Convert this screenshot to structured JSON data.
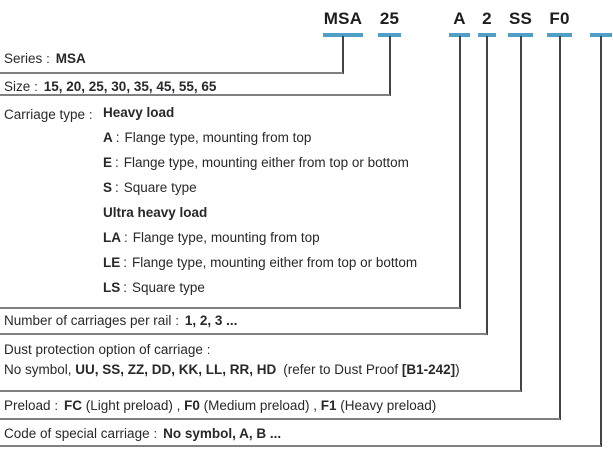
{
  "ui": {
    "colon": ":"
  },
  "colors": {
    "accent_blue": "#4f9fc6",
    "rule_gray": "#7e8083",
    "connector_gray": "#454347",
    "text": "#29272a"
  },
  "code": {
    "segments": [
      {
        "id": "series",
        "label": "MSA"
      },
      {
        "id": "size",
        "label": "25"
      },
      {
        "id": "carriage-type",
        "label": "A"
      },
      {
        "id": "carriages-per-rail",
        "label": "2"
      },
      {
        "id": "dust-protection",
        "label": "SS"
      },
      {
        "id": "preload",
        "label": "F0"
      },
      {
        "id": "special-carriage",
        "label": ""
      }
    ]
  },
  "rows": {
    "series": {
      "label": "Series",
      "value": "MSA"
    },
    "size": {
      "label": "Size",
      "value": "15, 20, 25, 30, 35, 45, 55, 65"
    },
    "carriage_type": {
      "label": "Carriage type",
      "groups": [
        {
          "heading": "Heavy load",
          "options": [
            {
              "code": "A",
              "desc": "Flange type, mounting from top"
            },
            {
              "code": "E",
              "desc": "Flange type, mounting either from top or bottom"
            },
            {
              "code": "S",
              "desc": "Square type"
            }
          ]
        },
        {
          "heading": "Ultra heavy load",
          "options": [
            {
              "code": "LA",
              "desc": "Flange type, mounting from top"
            },
            {
              "code": "LE",
              "desc": "Flange type, mounting either from top or bottom"
            },
            {
              "code": "LS",
              "desc": "Square type"
            }
          ]
        }
      ]
    },
    "carriages_per_rail": {
      "label": "Number of carriages per rail",
      "value": "1, 2, 3 ..."
    },
    "dust_protection": {
      "label": "Dust protection option of carriage",
      "prefix": "No symbol,",
      "codes": "UU, SS, ZZ, DD, KK, LL, RR, HD",
      "note_pre": "(refer to Dust Proof",
      "note_ref": "[B1-242]",
      "note_post": ")"
    },
    "preload": {
      "label": "Preload",
      "items": [
        {
          "code": "FC",
          "desc": "(Light preload) ,"
        },
        {
          "code": "F0",
          "desc": "(Medium preload) ,"
        },
        {
          "code": "F1",
          "desc": "(Heavy preload)"
        }
      ]
    },
    "special_carriage": {
      "label": "Code of special carriage",
      "value": "No symbol, A, B ..."
    }
  }
}
